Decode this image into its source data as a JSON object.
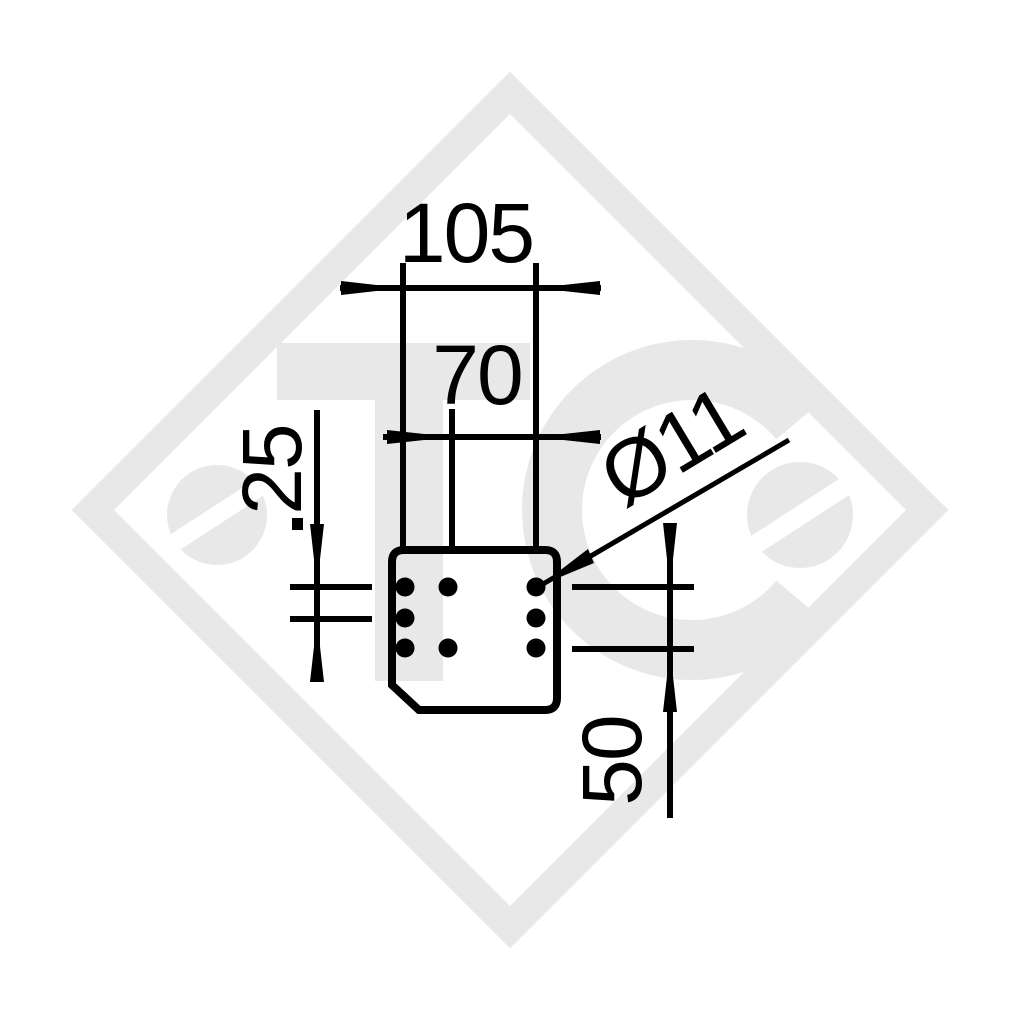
{
  "page": {
    "background": "#ffffff"
  },
  "drawing": {
    "watermark": {
      "text": "TCe",
      "color": "#e8e8e8"
    },
    "linework_color": "#000000",
    "labels": {
      "width_outer": "105",
      "width_inner": "70",
      "row_spacing": "25",
      "row_span": "50",
      "hole_diameter": "Ø11"
    }
  }
}
